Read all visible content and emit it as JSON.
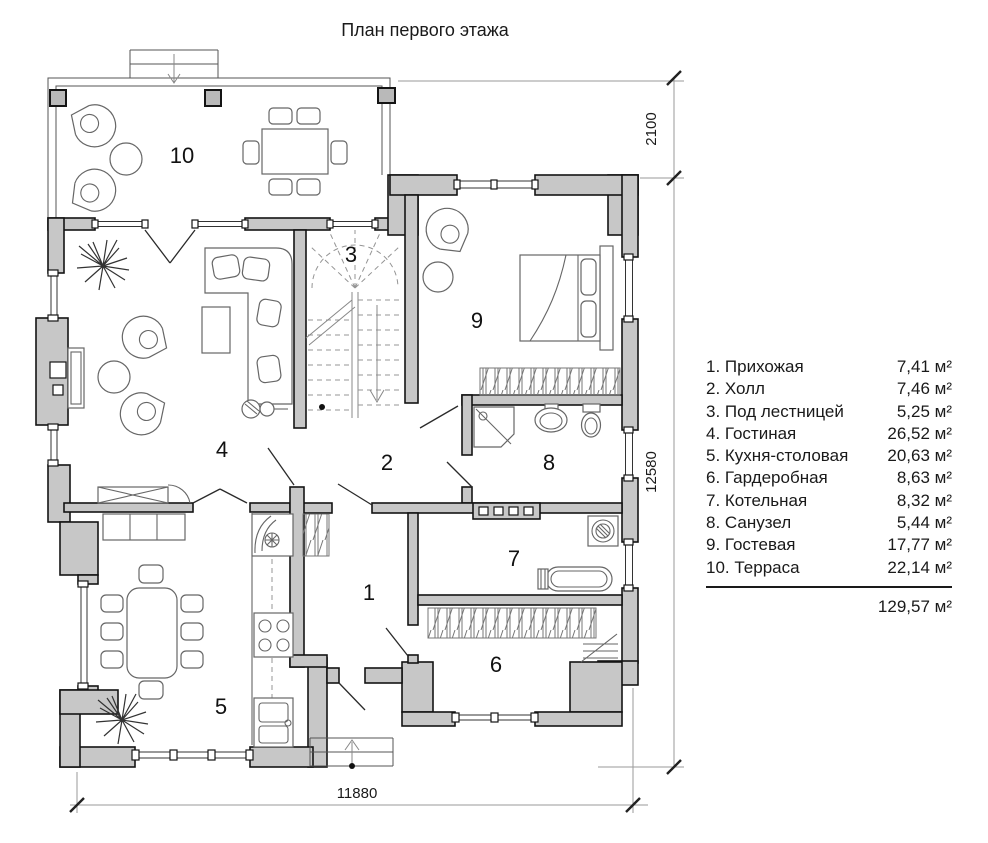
{
  "title": "План первого этажа",
  "legend": {
    "items": [
      {
        "label": "1. Прихожая",
        "area": "7,41 м²"
      },
      {
        "label": "2. Холл",
        "area": "7,46 м²"
      },
      {
        "label": "3. Под лестницей",
        "area": "5,25 м²"
      },
      {
        "label": "4. Гостиная",
        "area": "26,52 м²"
      },
      {
        "label": "5. Кухня-столовая",
        "area": "20,63 м²"
      },
      {
        "label": "6. Гардеробная",
        "area": "8,63 м²"
      },
      {
        "label": "7. Котельная",
        "area": "8,32 м²"
      },
      {
        "label": "8. Санузел",
        "area": "5,44 м²"
      },
      {
        "label": "9. Гостевая",
        "area": "17,77 м²"
      },
      {
        "label": "10. Терраса",
        "area": "22,14 м²"
      }
    ],
    "total": "129,57 м²"
  },
  "plan_labels": [
    "1",
    "2",
    "3",
    "4",
    "5",
    "6",
    "7",
    "8",
    "9",
    "10"
  ],
  "dimensions": {
    "terrace_depth": "2100",
    "height": "12580",
    "width": "11880"
  },
  "colors": {
    "wall_fill": "#c7c7c7",
    "line": "#141414",
    "background": "#ffffff"
  }
}
